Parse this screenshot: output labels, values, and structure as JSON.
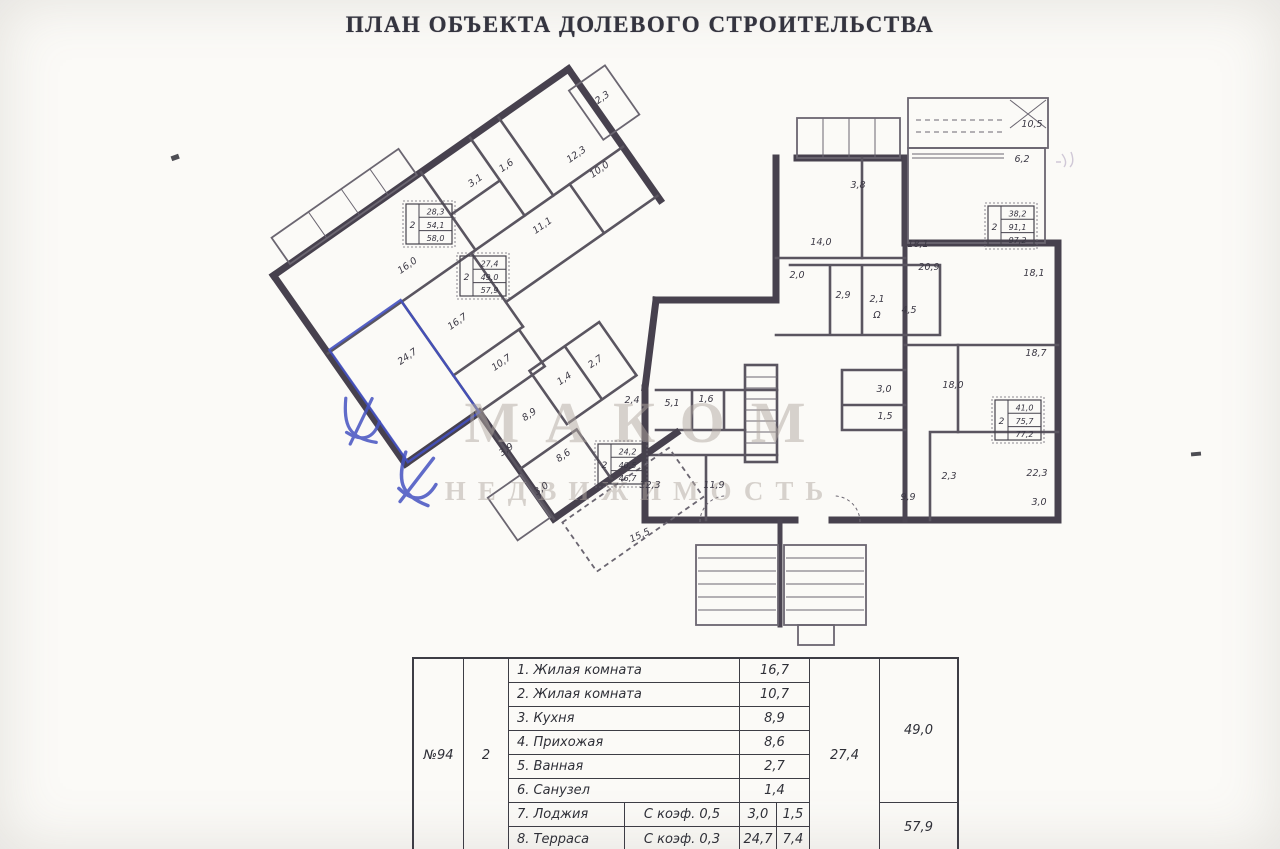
{
  "header": {
    "title": "ПЛАН ОБЪЕКТА ДОЛЕВОГО СТРОИТЕЛЬСТВА"
  },
  "watermark": {
    "line1": "МАКОМ",
    "line2": "НЕДВИЖИМОСТЬ"
  },
  "colors": {
    "ink": "#3c3945",
    "wall": "#47414e",
    "pen_blue": "#4350c0",
    "watermark": "#b3aaa2"
  },
  "plan": {
    "area_labels": [
      {
        "text": "2,3",
        "x": 604,
        "y": 100,
        "rot": -35
      },
      {
        "text": "12,3",
        "x": 578,
        "y": 157,
        "rot": -35
      },
      {
        "text": "10,0",
        "x": 601,
        "y": 172,
        "rot": -35
      },
      {
        "text": "1,6",
        "x": 508,
        "y": 168,
        "rot": -35
      },
      {
        "text": "3,1",
        "x": 477,
        "y": 183,
        "rot": -35
      },
      {
        "text": "11,1",
        "x": 544,
        "y": 228,
        "rot": -35
      },
      {
        "text": "16,0",
        "x": 409,
        "y": 268,
        "rot": -35
      },
      {
        "text": "16,7",
        "x": 459,
        "y": 324,
        "rot": -35
      },
      {
        "text": "24,7",
        "x": 409,
        "y": 359,
        "rot": -35
      },
      {
        "text": "10,7",
        "x": 503,
        "y": 365,
        "rot": -35
      },
      {
        "text": "2,7",
        "x": 597,
        "y": 364,
        "rot": -35
      },
      {
        "text": "1,4",
        "x": 566,
        "y": 381,
        "rot": -35
      },
      {
        "text": "8,9",
        "x": 531,
        "y": 417,
        "rot": -35
      },
      {
        "text": "3,9",
        "x": 508,
        "y": 452,
        "rot": -35
      },
      {
        "text": "8,6",
        "x": 565,
        "y": 458,
        "rot": -35
      },
      {
        "text": "3,0",
        "x": 543,
        "y": 491,
        "rot": -35
      },
      {
        "text": "15,5",
        "x": 641,
        "y": 538,
        "rot": -25
      },
      {
        "text": "2,4",
        "x": 632,
        "y": 403,
        "rot": 0
      },
      {
        "text": "5,1",
        "x": 672,
        "y": 406,
        "rot": 0
      },
      {
        "text": "1,6",
        "x": 706,
        "y": 402,
        "rot": 0
      },
      {
        "text": "12,3",
        "x": 650,
        "y": 488,
        "rot": 0
      },
      {
        "text": "11,9",
        "x": 714,
        "y": 488,
        "rot": 0
      },
      {
        "text": "3,8",
        "x": 858,
        "y": 188,
        "rot": 0
      },
      {
        "text": "14,0",
        "x": 821,
        "y": 245,
        "rot": 0
      },
      {
        "text": "18,1",
        "x": 918,
        "y": 247,
        "rot": 0
      },
      {
        "text": "20,9",
        "x": 929,
        "y": 270,
        "rot": 0
      },
      {
        "text": "2,0",
        "x": 797,
        "y": 278,
        "rot": 0
      },
      {
        "text": "2,9",
        "x": 843,
        "y": 298,
        "rot": 0
      },
      {
        "text": "2,1",
        "x": 877,
        "y": 302,
        "rot": 0
      },
      {
        "text": "4,5",
        "x": 909,
        "y": 313,
        "rot": 0
      },
      {
        "text": "Ω",
        "x": 877,
        "y": 318,
        "rot": 0
      },
      {
        "text": "10,5",
        "x": 1032,
        "y": 127,
        "rot": 0
      },
      {
        "text": "6,2",
        "x": 1022,
        "y": 162,
        "rot": 0
      },
      {
        "text": "18,1",
        "x": 1034,
        "y": 276,
        "rot": 0
      },
      {
        "text": "18,7",
        "x": 1036,
        "y": 356,
        "rot": 0
      },
      {
        "text": "18,0",
        "x": 953,
        "y": 388,
        "rot": 0
      },
      {
        "text": "3,0",
        "x": 884,
        "y": 392,
        "rot": 0
      },
      {
        "text": "1,5",
        "x": 885,
        "y": 419,
        "rot": 0
      },
      {
        "text": "2,3",
        "x": 949,
        "y": 479,
        "rot": 0
      },
      {
        "text": "22,3",
        "x": 1037,
        "y": 476,
        "rot": 0
      },
      {
        "text": "9,9",
        "x": 908,
        "y": 500,
        "rot": 0
      },
      {
        "text": "3,0",
        "x": 1039,
        "y": 505,
        "rot": 0
      }
    ],
    "stamps": [
      {
        "rooms": "2",
        "values": [
          "28,3",
          "54,1",
          "58,0"
        ],
        "x": 406,
        "y": 204
      },
      {
        "rooms": "2",
        "values": [
          "27,4",
          "49,0",
          "57,9"
        ],
        "x": 460,
        "y": 256
      },
      {
        "rooms": "2",
        "values": [
          "24,2",
          "40,5",
          "46,7"
        ],
        "x": 598,
        "y": 444
      },
      {
        "rooms": "2",
        "values": [
          "38,2",
          "91,1",
          "97,2"
        ],
        "x": 988,
        "y": 206
      },
      {
        "rooms": "2",
        "values": [
          "41,0",
          "75,7",
          "77,2"
        ],
        "x": 995,
        "y": 400
      }
    ]
  },
  "table": {
    "apartment_number": "№94",
    "rooms_count": "2",
    "rows": [
      {
        "name": "1. Жилая комната",
        "area": "16,7"
      },
      {
        "name": "2. Жилая комната",
        "area": "10,7"
      },
      {
        "name": "3. Кухня",
        "area": "8,9"
      },
      {
        "name": "4. Прихожая",
        "area": "8,6"
      },
      {
        "name": "5. Ванная",
        "area": "2,7"
      },
      {
        "name": "6. Санузел",
        "area": "1,4"
      },
      {
        "name": "7. Лоджия",
        "coef": "С коэф. 0,5",
        "area": "3,0",
        "reduced": "1,5"
      },
      {
        "name": "8. Терраса",
        "coef": "С коэф. 0,3",
        "area": "24,7",
        "reduced": "7,4"
      }
    ],
    "living_total": "27,4",
    "total_area": "49,0",
    "total_with_cold": "57,9"
  }
}
